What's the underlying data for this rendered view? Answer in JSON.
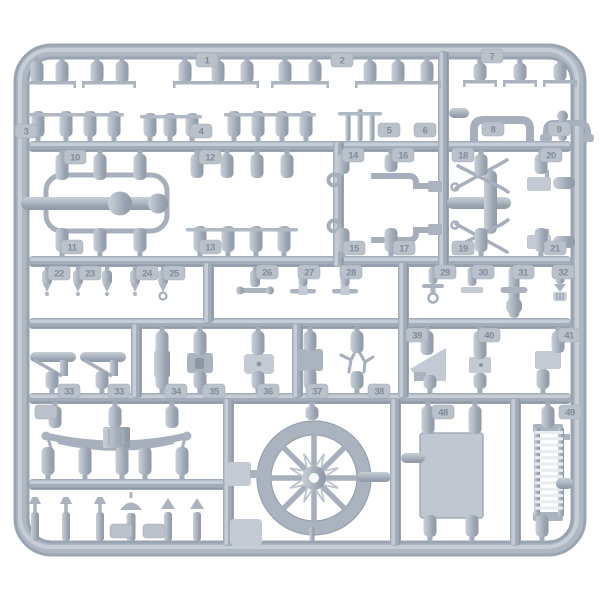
{
  "colors": {
    "background": "#ffffff",
    "plastic": "#a9b2bd",
    "plastic_light": "#c3cad3",
    "plastic_dark": "#8d97a4",
    "tag_chip": "#bac1cb",
    "tag_text": "#818c99"
  },
  "tags": [
    {
      "label": "1",
      "x": 207,
      "y": 60
    },
    {
      "label": "2",
      "x": 342,
      "y": 60
    },
    {
      "label": "7",
      "x": 492,
      "y": 56
    },
    {
      "label": "3",
      "x": 26,
      "y": 131
    },
    {
      "label": "4",
      "x": 201,
      "y": 131
    },
    {
      "label": "5",
      "x": 389,
      "y": 130
    },
    {
      "label": "6",
      "x": 425,
      "y": 130
    },
    {
      "label": "8",
      "x": 493,
      "y": 129
    },
    {
      "label": "9",
      "x": 559,
      "y": 129
    },
    {
      "label": "10",
      "x": 75,
      "y": 157
    },
    {
      "label": "12",
      "x": 210,
      "y": 157
    },
    {
      "label": "14",
      "x": 353,
      "y": 155
    },
    {
      "label": "16",
      "x": 403,
      "y": 155
    },
    {
      "label": "18",
      "x": 463,
      "y": 155
    },
    {
      "label": "20",
      "x": 551,
      "y": 155
    },
    {
      "label": "11",
      "x": 72,
      "y": 247
    },
    {
      "label": "13",
      "x": 210,
      "y": 247
    },
    {
      "label": "15",
      "x": 354,
      "y": 248
    },
    {
      "label": "17",
      "x": 404,
      "y": 248
    },
    {
      "label": "19",
      "x": 463,
      "y": 248
    },
    {
      "label": "21",
      "x": 555,
      "y": 248
    },
    {
      "label": "22",
      "x": 59,
      "y": 273
    },
    {
      "label": "23",
      "x": 90,
      "y": 273
    },
    {
      "label": "24",
      "x": 147,
      "y": 273
    },
    {
      "label": "25",
      "x": 174,
      "y": 273
    },
    {
      "label": "26",
      "x": 267,
      "y": 272
    },
    {
      "label": "27",
      "x": 309,
      "y": 272
    },
    {
      "label": "28",
      "x": 351,
      "y": 272
    },
    {
      "label": "29",
      "x": 445,
      "y": 272
    },
    {
      "label": "30",
      "x": 483,
      "y": 272
    },
    {
      "label": "31",
      "x": 523,
      "y": 272
    },
    {
      "label": "32",
      "x": 563,
      "y": 272
    },
    {
      "label": "39",
      "x": 417,
      "y": 335
    },
    {
      "label": "40",
      "x": 489,
      "y": 335
    },
    {
      "label": "41",
      "x": 569,
      "y": 335
    },
    {
      "label": "33",
      "x": 69,
      "y": 391
    },
    {
      "label": "33",
      "x": 119,
      "y": 391
    },
    {
      "label": "34",
      "x": 176,
      "y": 391
    },
    {
      "label": "35",
      "x": 214,
      "y": 391
    },
    {
      "label": "36",
      "x": 268,
      "y": 391
    },
    {
      "label": "37",
      "x": 317,
      "y": 391
    },
    {
      "label": "38",
      "x": 379,
      "y": 391
    },
    {
      "label": "",
      "x": 46,
      "y": 412
    },
    {
      "label": "48",
      "x": 443,
      "y": 412
    },
    {
      "label": "49",
      "x": 570,
      "y": 412
    },
    {
      "label": "",
      "x": 121,
      "y": 531
    },
    {
      "label": "",
      "x": 154,
      "y": 531
    }
  ],
  "parts": {
    "cyl_down": [
      [
        37,
        57,
        22
      ],
      [
        62,
        57,
        22
      ],
      [
        97,
        57,
        22
      ],
      [
        122,
        57,
        22
      ],
      [
        185,
        57,
        22
      ],
      [
        218,
        57,
        22
      ],
      [
        247,
        57,
        22
      ],
      [
        285,
        57,
        22
      ],
      [
        315,
        57,
        22
      ],
      [
        370,
        57,
        22
      ],
      [
        398,
        57,
        22
      ],
      [
        427,
        57,
        22
      ],
      [
        480,
        59,
        18
      ],
      [
        520,
        59,
        18
      ],
      [
        560,
        59,
        18
      ],
      [
        62,
        150,
        26
      ],
      [
        100,
        150,
        26
      ],
      [
        140,
        150,
        26
      ],
      [
        197,
        150,
        24
      ],
      [
        227,
        150,
        24
      ],
      [
        257,
        150,
        24
      ],
      [
        287,
        150,
        24
      ],
      [
        343,
        150,
        20
      ],
      [
        391,
        150,
        18
      ],
      [
        481,
        150,
        22
      ],
      [
        541,
        150,
        20
      ],
      [
        162,
        327,
        24
      ],
      [
        200,
        327,
        24
      ],
      [
        258,
        327,
        24
      ],
      [
        310,
        327,
        20
      ],
      [
        357,
        327,
        22
      ],
      [
        427,
        327,
        24
      ],
      [
        480,
        327,
        28
      ],
      [
        558,
        327,
        22
      ],
      [
        55,
        402,
        22
      ],
      [
        115,
        402,
        22
      ],
      [
        172,
        402,
        22
      ],
      [
        428,
        402,
        28
      ],
      [
        475,
        402,
        28
      ],
      [
        548,
        402,
        22
      ],
      [
        312,
        402,
        14
      ]
    ],
    "cyl_up": [
      [
        38,
        141,
        26
      ],
      [
        66,
        141,
        26
      ],
      [
        90,
        141,
        26
      ],
      [
        114,
        141,
        26
      ],
      [
        150,
        141,
        24
      ],
      [
        170,
        141,
        24
      ],
      [
        192,
        141,
        24
      ],
      [
        234,
        141,
        26
      ],
      [
        258,
        141,
        26
      ],
      [
        282,
        141,
        26
      ],
      [
        306,
        141,
        26
      ],
      [
        62,
        256,
        24
      ],
      [
        100,
        256,
        24
      ],
      [
        140,
        256,
        24
      ],
      [
        200,
        256,
        26
      ],
      [
        228,
        256,
        26
      ],
      [
        256,
        256,
        26
      ],
      [
        284,
        256,
        26
      ],
      [
        343,
        256,
        24
      ],
      [
        391,
        256,
        24
      ],
      [
        481,
        256,
        24
      ],
      [
        541,
        256,
        24
      ],
      [
        52,
        393,
        18
      ],
      [
        102,
        393,
        18
      ],
      [
        162,
        393,
        18
      ],
      [
        200,
        393,
        18
      ],
      [
        258,
        393,
        18
      ],
      [
        310,
        393,
        20
      ],
      [
        357,
        393,
        18
      ],
      [
        430,
        393,
        14
      ],
      [
        480,
        393,
        16
      ],
      [
        543,
        393,
        20
      ],
      [
        48,
        479,
        28
      ],
      [
        85,
        479,
        28
      ],
      [
        122,
        479,
        28
      ],
      [
        145,
        479,
        28
      ],
      [
        182,
        479,
        28
      ],
      [
        430,
        541,
        22
      ],
      [
        472,
        541,
        22
      ],
      [
        542,
        541,
        22
      ]
    ],
    "posts": [
      [
        348,
        141,
        24
      ],
      [
        360,
        141,
        28
      ],
      [
        372,
        141,
        24
      ],
      [
        312,
        541,
        10
      ]
    ],
    "tfeet": [
      [
        49,
        81,
        54
      ],
      [
        109,
        81,
        54
      ],
      [
        216,
        81,
        86
      ],
      [
        300,
        81,
        58
      ],
      [
        398,
        81,
        86
      ],
      [
        480,
        80,
        34
      ],
      [
        520,
        80,
        34
      ],
      [
        560,
        80,
        34
      ]
    ],
    "rails": [
      [
        28,
        124,
        113
      ],
      [
        140,
        202,
        115
      ],
      [
        224,
        316,
        113
      ],
      [
        338,
        382,
        112
      ],
      [
        186,
        298,
        228
      ]
    ],
    "e_parts": [
      {
        "x": 47,
        "v": "point"
      },
      {
        "x": 78,
        "v": "point"
      },
      {
        "x": 107,
        "v": "point"
      },
      {
        "x": 135,
        "v": "point"
      },
      {
        "x": 163,
        "v": "ring"
      },
      {
        "x": 255,
        "v": "dumbbell"
      },
      {
        "x": 303,
        "v": "tbar"
      },
      {
        "x": 345,
        "v": "tbar"
      },
      {
        "x": 433,
        "v": "anchor"
      },
      {
        "x": 472,
        "v": "pad"
      },
      {
        "x": 514,
        "v": "tall"
      },
      {
        "x": 560,
        "v": "ridge"
      }
    ],
    "valves": [
      {
        "x": 35,
        "v": "tee"
      },
      {
        "x": 66,
        "v": "tee"
      },
      {
        "x": 100,
        "v": "tee"
      },
      {
        "x": 131,
        "v": "umb"
      },
      {
        "x": 168,
        "v": "arrow"
      },
      {
        "x": 197,
        "v": "arrow"
      }
    ]
  }
}
